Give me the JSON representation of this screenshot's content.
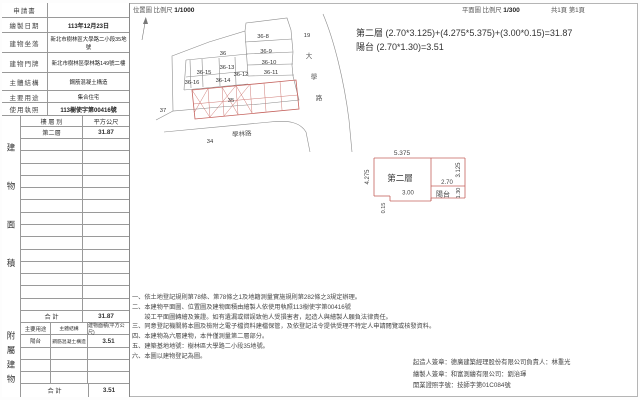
{
  "meta": {
    "pages": "共1頁 第1頁"
  },
  "colors": {
    "accent_red": "#c4615c",
    "line_gray": "#8c8c8c",
    "text": "#333333"
  },
  "location_map": {
    "title": "位置圖",
    "scale_label": "比例尺",
    "scale": "1/1000",
    "north_arrow": "north-arrow-icon",
    "parcels": [
      "36-8",
      "36-9",
      "36-10",
      "36-11",
      "36-12",
      "36-13",
      "36-14",
      "36-15",
      "36-16",
      "36",
      "35",
      "37",
      "34",
      "19"
    ],
    "road_right_chars": [
      "大",
      "學",
      "路"
    ],
    "road_bottom": "學林路"
  },
  "floor_plan_header": {
    "title": "平面圖",
    "scale_label": "比例尺",
    "scale": "1/300"
  },
  "formula": {
    "line1": "第二層 (2.70*3.125)+(4.275*5.375)+(3.00*0.15)=31.87",
    "line2": "陽台 (2.70*1.30)=3.51"
  },
  "plan": {
    "room": "第二層",
    "dim_top": "5.375",
    "dim_left": "4.275",
    "dim_right": "3.125",
    "dim_inner": "2.70",
    "balcony": "陽台",
    "dim_balcony": "1.30",
    "dim_bottom": "3.00",
    "dim_strip": "0.15"
  },
  "info": {
    "rows": [
      {
        "label": "申請書",
        "value": ""
      },
      {
        "label": "繪製日期",
        "value": "113年12月23日"
      },
      {
        "label": "建物坐落",
        "value": "新北市樹林區大學路二小段35地號"
      },
      {
        "label": "建物門牌",
        "value": "新北市樹林區學林路149號二樓"
      },
      {
        "label": "主體結構",
        "value": "鋼筋混凝土構造"
      },
      {
        "label": "主要用途",
        "value": "集合住宅"
      },
      {
        "label": "使用執照",
        "value": "113樹使字第00416號"
      }
    ]
  },
  "area_table": {
    "strip": "建物面積",
    "header": {
      "col1": "樓 層 別",
      "col2": "平方公尺"
    },
    "rows": [
      {
        "floor": "第二層",
        "area": "31.87"
      }
    ],
    "total_label": "合  計",
    "total": "31.87"
  },
  "attached_table": {
    "strip": "附屬建物",
    "header": {
      "col1": "主要用途",
      "col2": "主體結構",
      "col3": "建物面積(平方公尺)"
    },
    "rows": [
      {
        "use": "陽台",
        "structure": "鋼筋混凝土構造",
        "area": "3.51"
      }
    ],
    "total_label": "合  計",
    "total": "3.51"
  },
  "notes": {
    "lines": [
      "一、依土地登記規則第78條、第78條之1及地籍測量實施規則第282條之3規定辦理。",
      "二、本建物平面圖、位置圖及建物面積由繪製人依使用執照113樹使字第00416號",
      "　　竣工平面圖轉繪及簽證。如有遺漏或錯誤致他人受損害者，起造人與繪製人願負法律責任。",
      "三、同意登記機關將本圖及檢附之電子檔資料建檔保管，及依登記法令提供受理不特定人申請閱覽或核發資料。",
      "四、本建物為六層建物，本件僅測量第二層部分。",
      "五、建築基地地號：樹林區大學路二小段35地號。",
      "六、本圖以建物登記為圖。"
    ]
  },
  "signatures": {
    "lines": [
      "起造人簽章：德廣建築經理股份有限公司負責人：林重光",
      "繪製人簽章：和富測繪有限公司：劉治琿",
      "開業證照字號：技師字第01C084號"
    ]
  }
}
